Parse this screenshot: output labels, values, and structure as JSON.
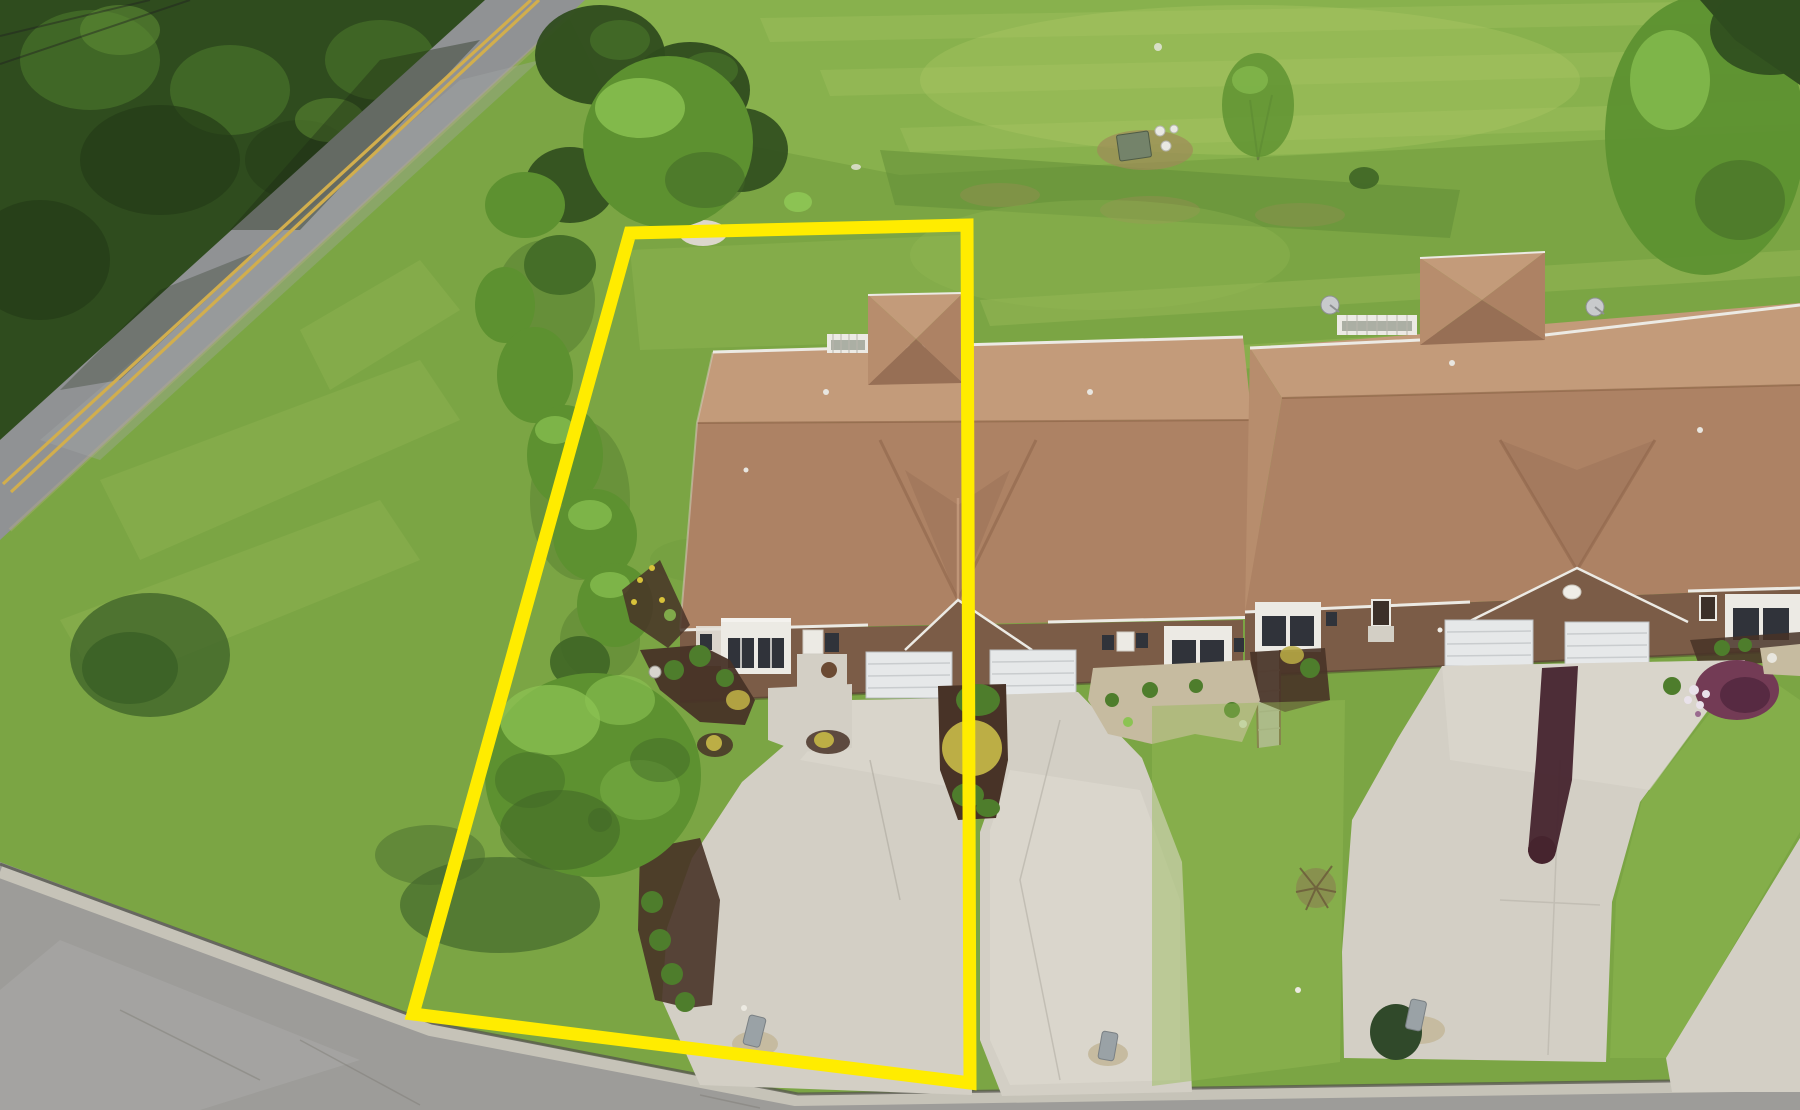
{
  "meta": {
    "title": "Aerial drone photo of a duplex-townhome lot with a yellow highlighted property boundary",
    "type": "photograph",
    "view": "top-down oblique aerial"
  },
  "boundary": {
    "points": "630,233 967,225 970,1083 413,1014",
    "stroke_width": "13",
    "label": "highlighted lot outline"
  },
  "colors": {
    "grass_base": "#7ba544",
    "grass_light": "#94bb55",
    "grass_pale": "#b3cc6b",
    "grass_dark": "#5f8c35",
    "grass_shadow": "#44692c",
    "forest_dark": "#2f4c1e",
    "forest_mid": "#456e28",
    "forest_light": "#5d8a33",
    "tree_mid": "#5d9130",
    "tree_light": "#8cc353",
    "tree_dark": "#3f6626",
    "road_asphalt": "#909294",
    "road_light": "#a7a9aa",
    "road_line_yellow": "#d2ae4d",
    "street_asphalt": "#9d9c99",
    "street_light": "#aeadaa",
    "curb_concrete": "#c6c3b8",
    "curb_shadow": "#55554e",
    "concrete": "#d3cfc5",
    "concrete_bright": "#e0dcd2",
    "concrete_shade": "#c0bcb2",
    "roof_back": "#c39b7a",
    "roof_front": "#ad8264",
    "roof_side": "#b78d6d",
    "roof_dark": "#976f55",
    "roof_valley": "#8a6045",
    "brick": "#7b5c47",
    "brick_dark": "#664a38",
    "white_trim": "#eceae4",
    "garage_door": "#e6e8e9",
    "window_glass": "#30333a",
    "mulch": "#483327",
    "gravel": "#c6bba0",
    "bush_green": "#4e7d2c",
    "bush_yellow": "#bcae45",
    "bush_purple": "#733b55",
    "stain_maroon": "#46242e",
    "utility_gray": "#9aa2a6",
    "utility_green": "#74836a",
    "dirt": "#a08a58",
    "boundary_yellow": "#ffec00"
  },
  "scene": {
    "road": {
      "name": "country road",
      "marking": "double yellow center line"
    },
    "street": {
      "name": "subdivision street with concrete curb"
    },
    "buildings": [
      {
        "name": "left duplex",
        "units": "2",
        "features": "tan shingle hip roof, rear cupola, white rear deck rail, center front gable, two white garage doors, two bay windows, front porch"
      },
      {
        "name": "right duplex",
        "units": "2",
        "features": "tan shingle hip roof, rear wing, two satellite dishes, front gable with oval vent, two white garage doors, bay windows, dark stained strip on driveway"
      }
    ],
    "landscape": "dense forest upper-left, open mowed field, tree row along west lot line, tree with white mulch ring at rear lot line, large shade tree in front yard, foundation shrubs, yellow and green bushes, purple shrub, mulch and river-rock beds",
    "utilities": "green utility cabinet with white marker pipes in field, three gray utility pedestals along street"
  }
}
